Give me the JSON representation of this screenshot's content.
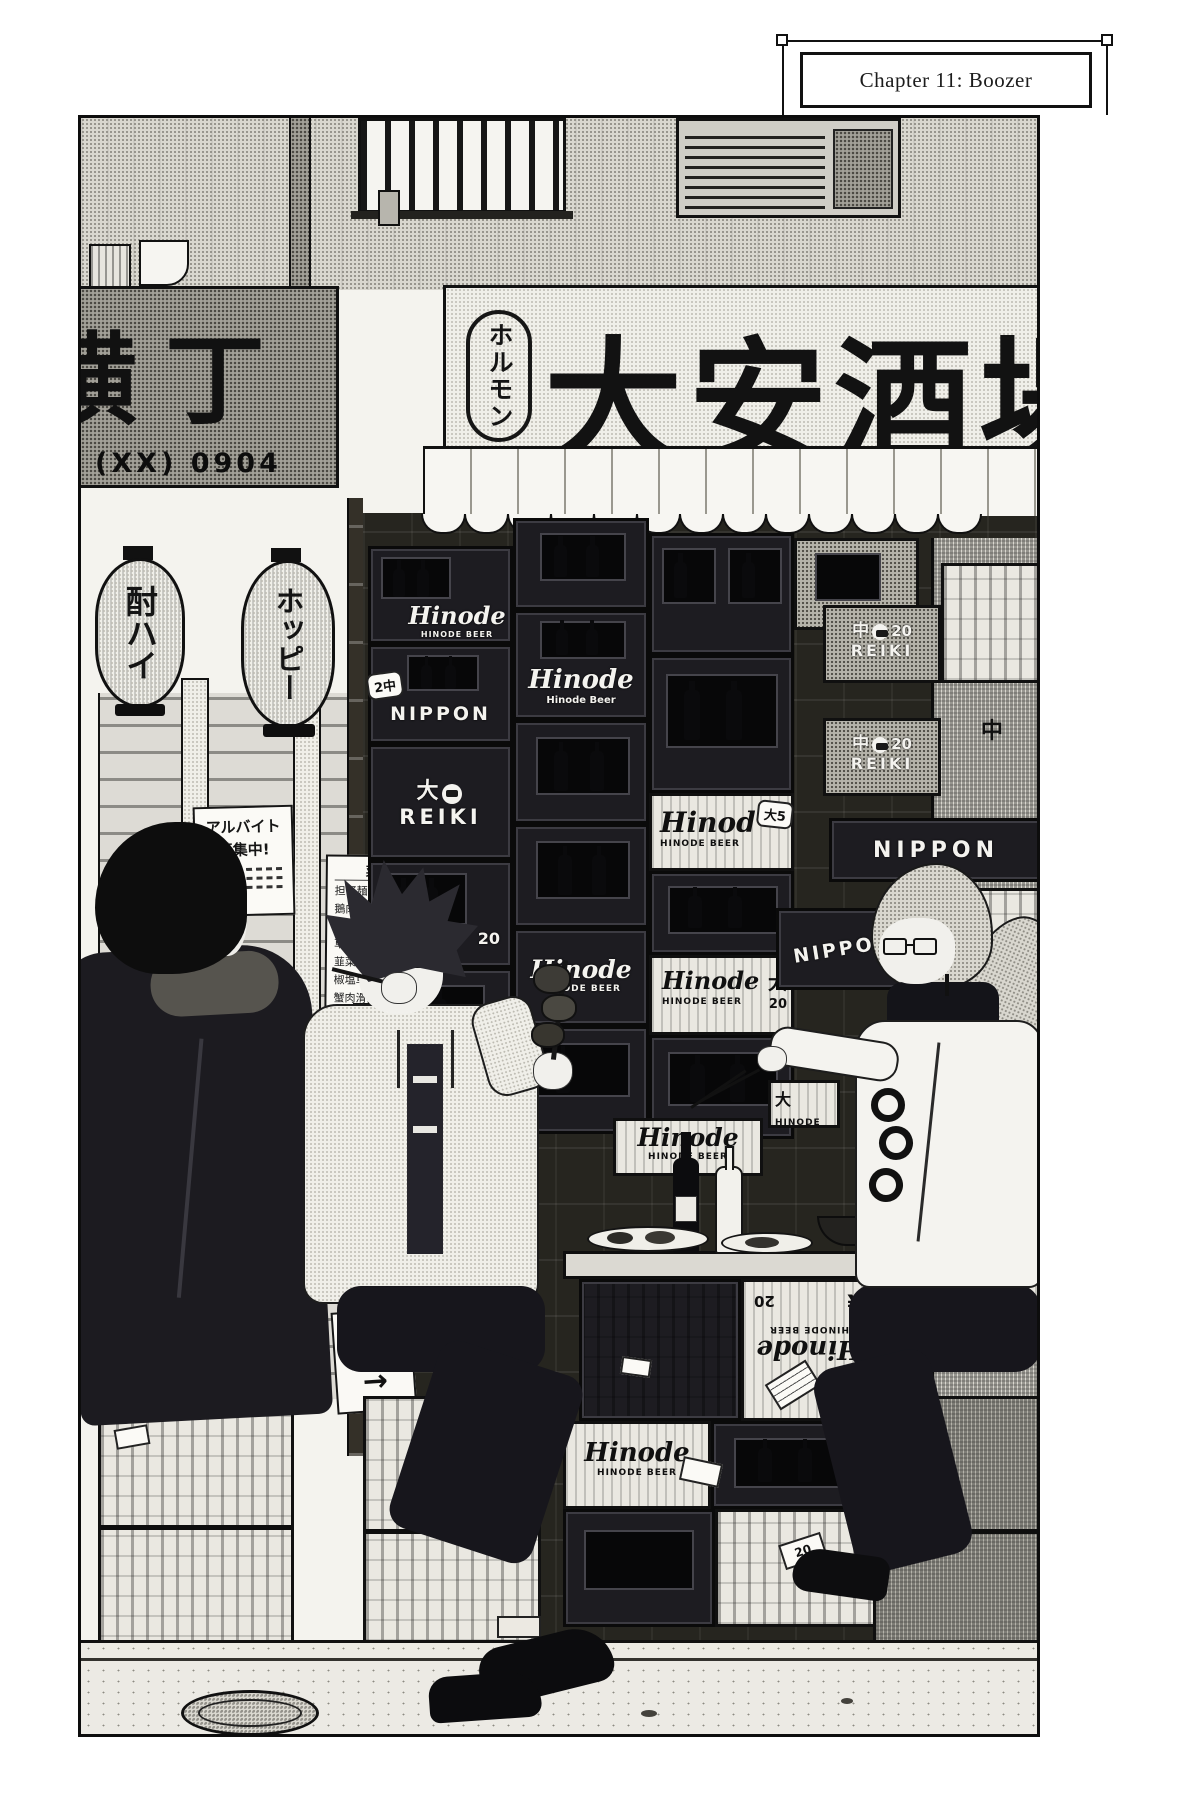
{
  "page": {
    "chapter_title": "Chapter 11: Boozer"
  },
  "storefront": {
    "awning_sign": {
      "badge_vertical": "ホルモン",
      "shop_name": "大安酒場"
    },
    "side_sign": {
      "name": "横丁",
      "phone": "(XX) 0904"
    },
    "lanterns": {
      "left": "酎ハイ",
      "right": "ホッピー"
    }
  },
  "posters": {
    "recruit_line1": "アルバイト",
    "recruit_line2": "募集中!",
    "smoking_ok": "喫煙OK",
    "payment_line1": "お会計は",
    "payment_line2": "コチラ",
    "payment_arrow": "→"
  },
  "menu": {
    "title": "菜単",
    "items": [
      {
        "name": "担仔麺",
        "price": "250"
      },
      {
        "name": "鵝肉麺",
        "price": "350"
      },
      {
        "name": "蚵仔煎",
        "price": "650"
      },
      {
        "name": "草菇肉糸",
        "price": "800"
      },
      {
        "name": "韮菜豚肝",
        "price": "750"
      },
      {
        "name": "椒塩草菇",
        "price": "600"
      },
      {
        "name": "蟹肉滑蛋",
        "price": "850"
      },
      {
        "name": "五更腸旺",
        "price": "1000"
      }
    ]
  },
  "crates": {
    "hinode_script": "Hinode",
    "hinode_script_short": "Hinod",
    "hinode_caps": "HINODE BEER",
    "hinode_beer_title": "Hinode Beer",
    "hinode_word": "HINODE",
    "nippon": "NIPPON",
    "reiki": "REIKI",
    "size_large": "大",
    "size_medium": "中",
    "qty_20": "20",
    "tag_2_medium": "2中",
    "tag_large_5": "大5",
    "yen_mark": "¥"
  }
}
